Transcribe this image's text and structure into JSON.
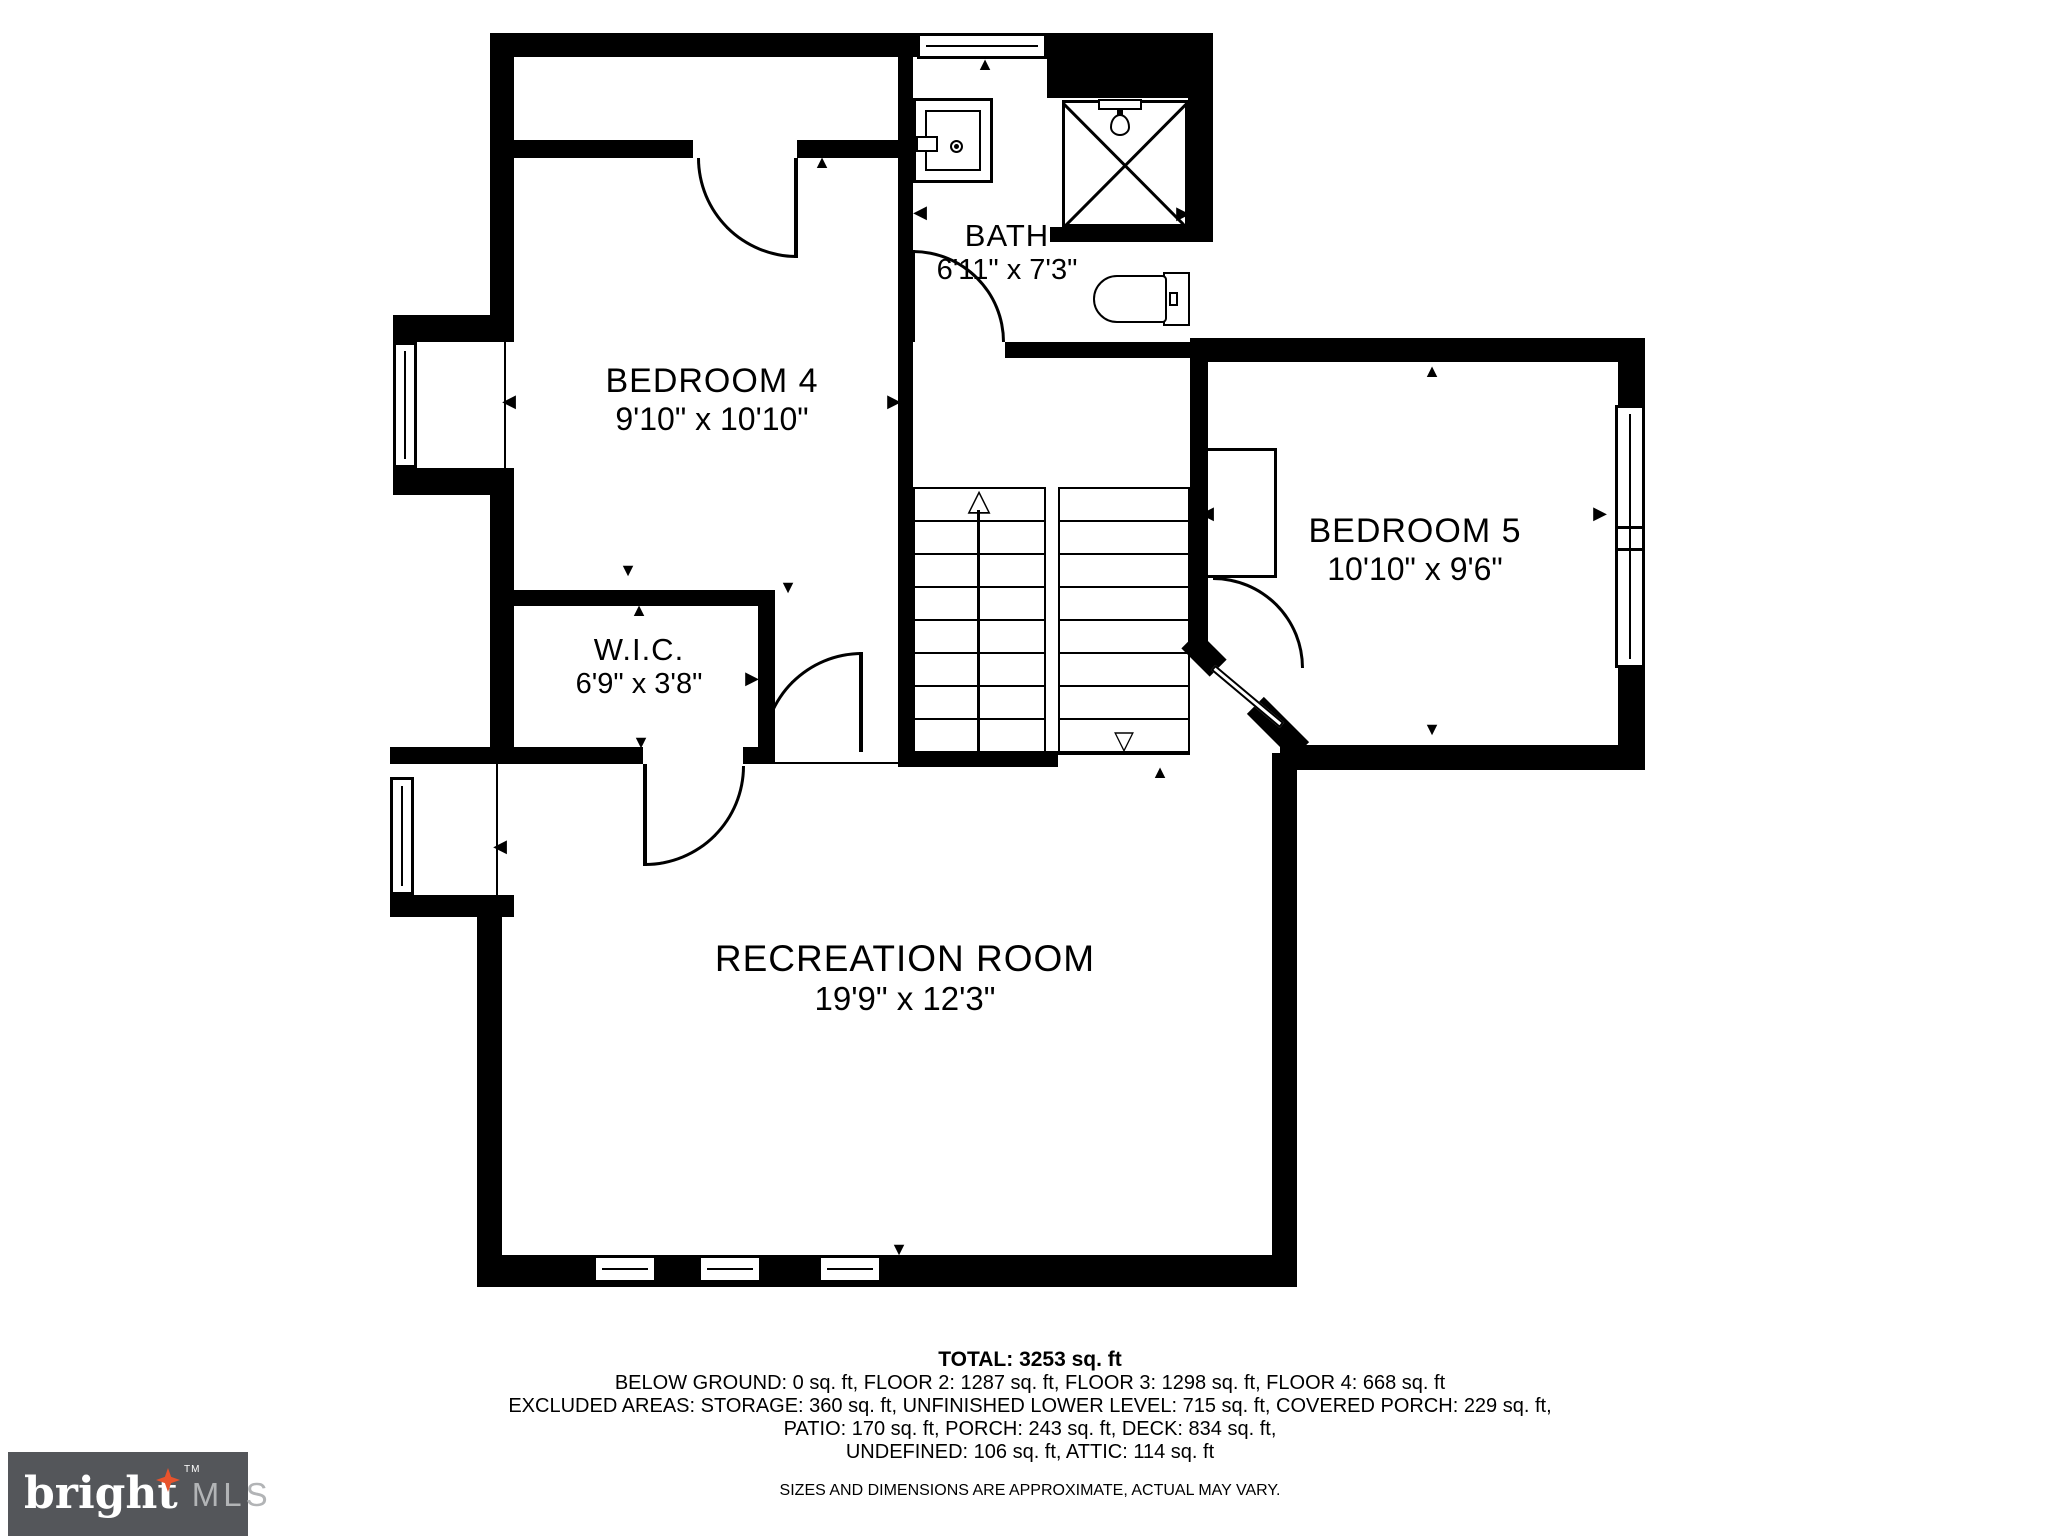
{
  "rooms": {
    "bedroom4": {
      "name": "BEDROOM 4",
      "dims": "9'10\" x 10'10\""
    },
    "bath": {
      "name": "BATH",
      "dims": "6'11\" x 7'3\""
    },
    "bedroom5": {
      "name": "BEDROOM 5",
      "dims": "10'10\" x 9'6\""
    },
    "wic": {
      "name": "W.I.C.",
      "dims": "6'9\" x 3'8\""
    },
    "recreation": {
      "name": "RECREATION ROOM",
      "dims": "19'9\" x 12'3\""
    }
  },
  "summary": {
    "total": "TOTAL: 3253 sq. ft",
    "floors": "BELOW GROUND: 0 sq. ft, FLOOR 2: 1287 sq. ft, FLOOR 3: 1298 sq. ft, FLOOR 4: 668 sq. ft",
    "excluded1": "EXCLUDED AREAS: STORAGE: 360 sq. ft, UNFINISHED LOWER LEVEL: 715 sq. ft, COVERED PORCH: 229 sq. ft,",
    "excluded2": "PATIO: 170 sq. ft, PORCH: 243 sq. ft, DECK: 834 sq. ft,",
    "excluded3": "UNDEFINED: 106 sq. ft, ATTIC: 114 sq. ft",
    "disclaimer": "SIZES AND DIMENSIONS ARE APPROXIMATE, ACTUAL MAY VARY."
  },
  "logo": {
    "brand": "bright",
    "tm": "TM",
    "suffix": "MLS"
  },
  "colors": {
    "line": "#000000",
    "logo_bg": "#54565a",
    "logo_text": "#ffffff",
    "logo_suffix": "#b2b4b6",
    "logo_accent": "#e8532c"
  },
  "icons": {
    "tri_up": "▲",
    "tri_down": "▼",
    "tri_left": "◀",
    "tri_right": "▶",
    "open_up": "△",
    "open_down": "▽"
  }
}
